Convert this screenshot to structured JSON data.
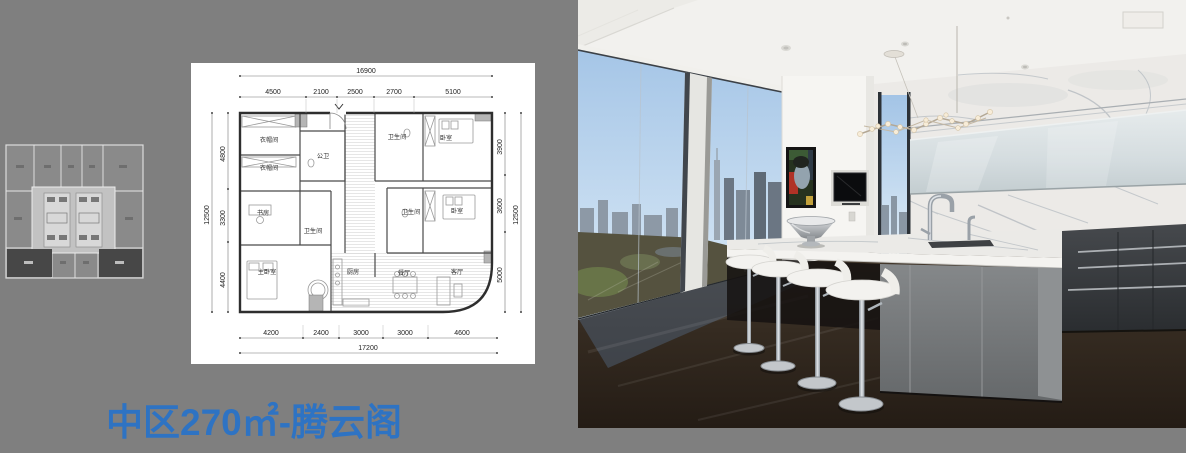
{
  "page": {
    "background_color": "#7F7F7F",
    "title": "中区270㎡-腾云阁",
    "title_color": "#2E73C3"
  },
  "key_plan": {
    "highlight_unit_color": "#474747",
    "plate_color": "#8A8A8A",
    "core_color": "#C2C2C2"
  },
  "floor_plan": {
    "paper_color": "#FFFFFF",
    "dims": {
      "top_total": "16900",
      "top_segments": [
        "4500",
        "2100",
        "2500",
        "2700",
        "5100"
      ],
      "bottom_total": "17200",
      "bottom_segments": [
        "4200",
        "2400",
        "3000",
        "3000",
        "4600"
      ],
      "left_total": "12500",
      "left_segments": [
        "4800",
        "3300",
        "4400"
      ],
      "right_total": "12500",
      "right_segments": [
        "3900",
        "3600",
        "5000"
      ]
    },
    "rooms": [
      {
        "label": "衣帽间"
      },
      {
        "label": "衣帽间"
      },
      {
        "label": "公卫"
      },
      {
        "label": "卫生间"
      },
      {
        "label": "卧室"
      },
      {
        "label": "书房"
      },
      {
        "label": "卫生间"
      },
      {
        "label": "卫生间"
      },
      {
        "label": "卧室"
      },
      {
        "label": "主卧室"
      },
      {
        "label": "厨房"
      },
      {
        "label": "餐厅"
      },
      {
        "label": "客厅"
      }
    ]
  },
  "photo": {
    "palette": {
      "sky": "#A3C4E6",
      "park": "#55523F",
      "wood_floor": "#2A211A",
      "marble": "#ECEAE7",
      "dark_cabinets": "#3B3E42",
      "island_base": "#7F8284",
      "stool_white": "#F3F2EF"
    }
  }
}
